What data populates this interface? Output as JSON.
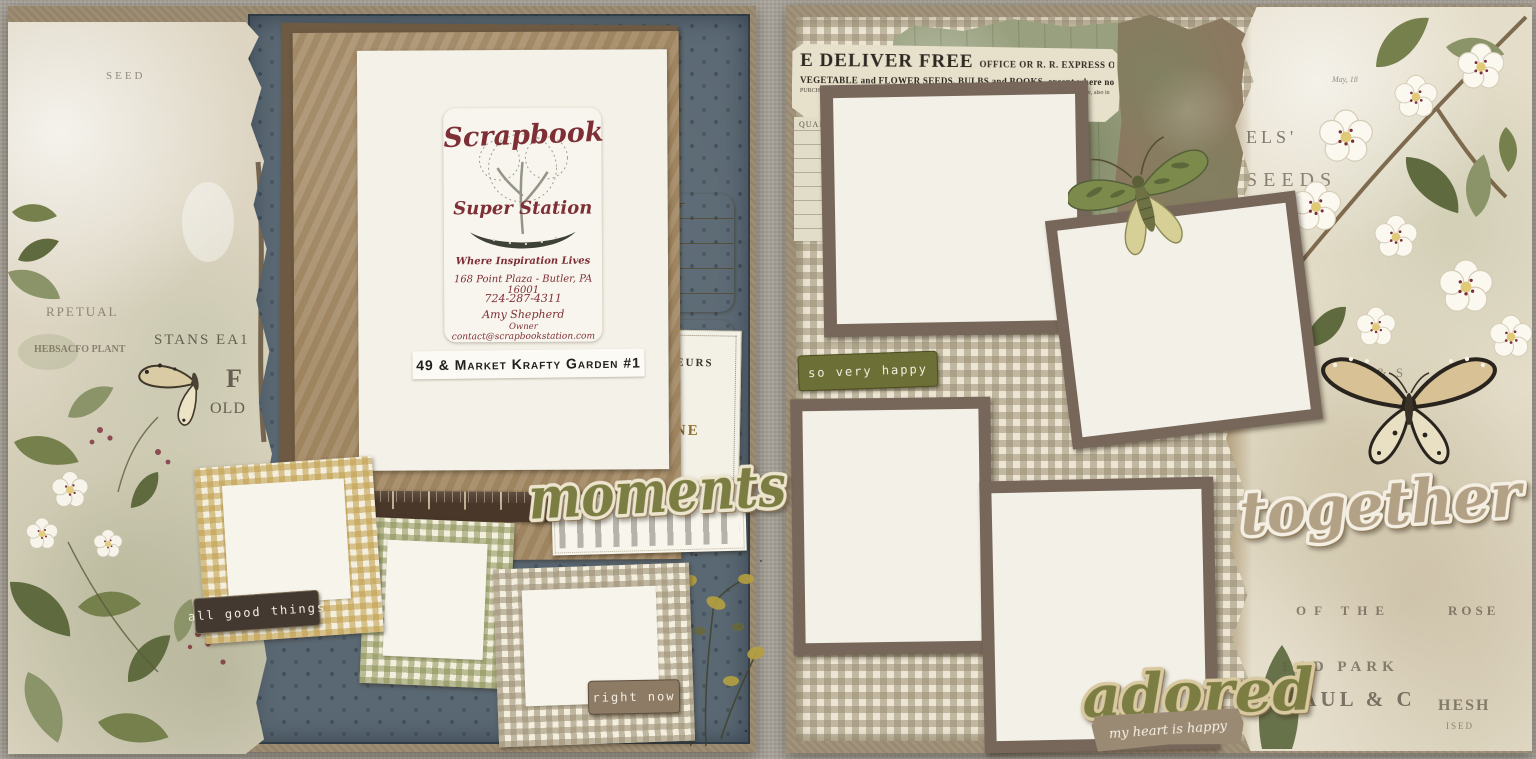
{
  "palette": {
    "olive_green_wordart": "#7b7d42",
    "tan_wordart": "#b3a186",
    "maroon_card_text": "#7e2f35",
    "gold_ticket": "#c9ad55",
    "blue_patterned_paper": "#5a6873",
    "kraft_page_edge": "#9c8d75",
    "label_dark_brown": "#443931",
    "label_taupe": "#8d7b66",
    "label_olive": "#6d7036",
    "gingham_cream": "#ece5d3"
  },
  "left_page": {
    "business_card": {
      "title_line1": "Scrapbook",
      "title_line2": "Super Station",
      "tagline": "Where Inspiration Lives",
      "address": "168 Point Plaza - Butler, PA  16001",
      "phone": "724-287-4311",
      "owner_name": "Amy Shepherd",
      "owner_title": "Owner",
      "email": "contact@scrapbookstation.com"
    },
    "kit_label": "49 & Market Krafty Garden #1",
    "word_art": "moments",
    "tag_all_good_things": "all good things",
    "tag_right_now": "right now",
    "ticket_mark": "x  —",
    "fleurs_card": {
      "line1": "FLEURS",
      "line2": "INE",
      "line3": "RIS"
    },
    "strip_fragments": {
      "f1": "SEED",
      "f2": "RPETUAL",
      "f3": "HEBSACFO PLANT",
      "f4": "STANS EA1",
      "f5": "F",
      "f6": "OLD",
      "f7": "1905"
    }
  },
  "right_page": {
    "catalog": {
      "headline": "E DELIVER FREE",
      "headline_rest": "OFFICE OR R. R. EXPRESS OFFICE IN THE UNITE",
      "line2": "VEGETABLE and FLOWER SEEDS, BULBS and BOOKS, except where noted.",
      "line3": "PURCHASER PAYS TRANSIT CHARGES only in BULBS and ROOTS in quantity where specially noted in Catalogue, also in",
      "col_quantity": "QUANTITY.",
      "col_price": "PRICE."
    },
    "tag_so_very_happy": "so very happy",
    "word_art_together": "together",
    "word_art_adored": "adored",
    "banner": "my heart is happy",
    "strip_fragments": {
      "f1": "ELS'",
      "f2": "SEEDS",
      "f3": "May, 18",
      "f4": "PAUL & S",
      "f5": "OF THE",
      "f6": "ROSE",
      "f7": "EAD PARK",
      "f8": "PAUL & C",
      "f9": "HESH",
      "f10": "ISED"
    }
  }
}
